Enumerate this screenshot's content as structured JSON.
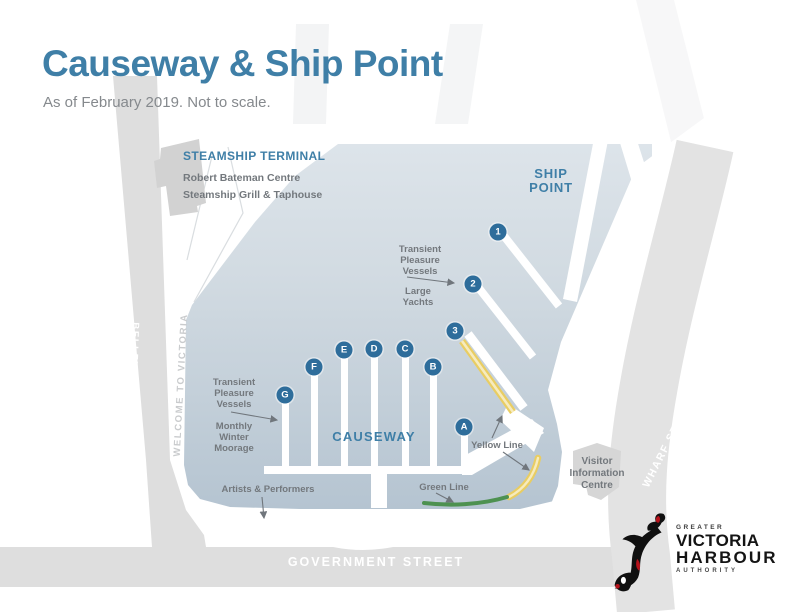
{
  "page": {
    "title": "Causeway & Ship Point",
    "subtitle": "As of February 2019. Not to scale."
  },
  "map": {
    "areas": {
      "steamship": {
        "title": "STEAMSHIP TERMINAL",
        "line1": "Robert Bateman Centre",
        "line2": "Steamship Grill & Taphouse"
      },
      "ship_point": "SHIP\nPOINT",
      "causeway": "CAUSEWAY"
    },
    "streets": {
      "belleville": "BELLEVILLE STREET",
      "welcome": "WELCOME TO VICTORIA",
      "wharf": "WHARF STREET",
      "government": "GOVERNMENT STREET"
    },
    "labels": {
      "transient_ship_point": "Transient\nPleasure\nVessels",
      "large_yachts": "Large\nYachts",
      "transient_causeway": "Transient\nPleasure\nVessels",
      "monthly_winter_moorage": "Monthly\nWinter\nMoorage",
      "artists": "Artists & Performers",
      "yellow_line": "Yellow Line",
      "green_line": "Green Line",
      "visitor_centre": "Visitor\nInformation\nCentre"
    },
    "markers": {
      "numbered": [
        "1",
        "2",
        "3"
      ],
      "lettered": [
        "A",
        "B",
        "C",
        "D",
        "E",
        "F",
        "G"
      ]
    },
    "colors": {
      "accent_blue": "#3f7fa7",
      "marker_blue": "#2e6d9b",
      "water_top": "#dde4ea",
      "water_bottom": "#b5c4d1",
      "street_gray": "#dedede",
      "building_gray": "#d2d2d2",
      "yellow_line": "#e9cd62",
      "green_line": "#4d9150",
      "label_gray": "#73787d"
    }
  },
  "logo": {
    "orca_icon": "orca-icon",
    "greater": "GREATER",
    "victoria": "VICTORIA",
    "harbour": "HARBOUR",
    "authority": "AUTHORITY"
  }
}
